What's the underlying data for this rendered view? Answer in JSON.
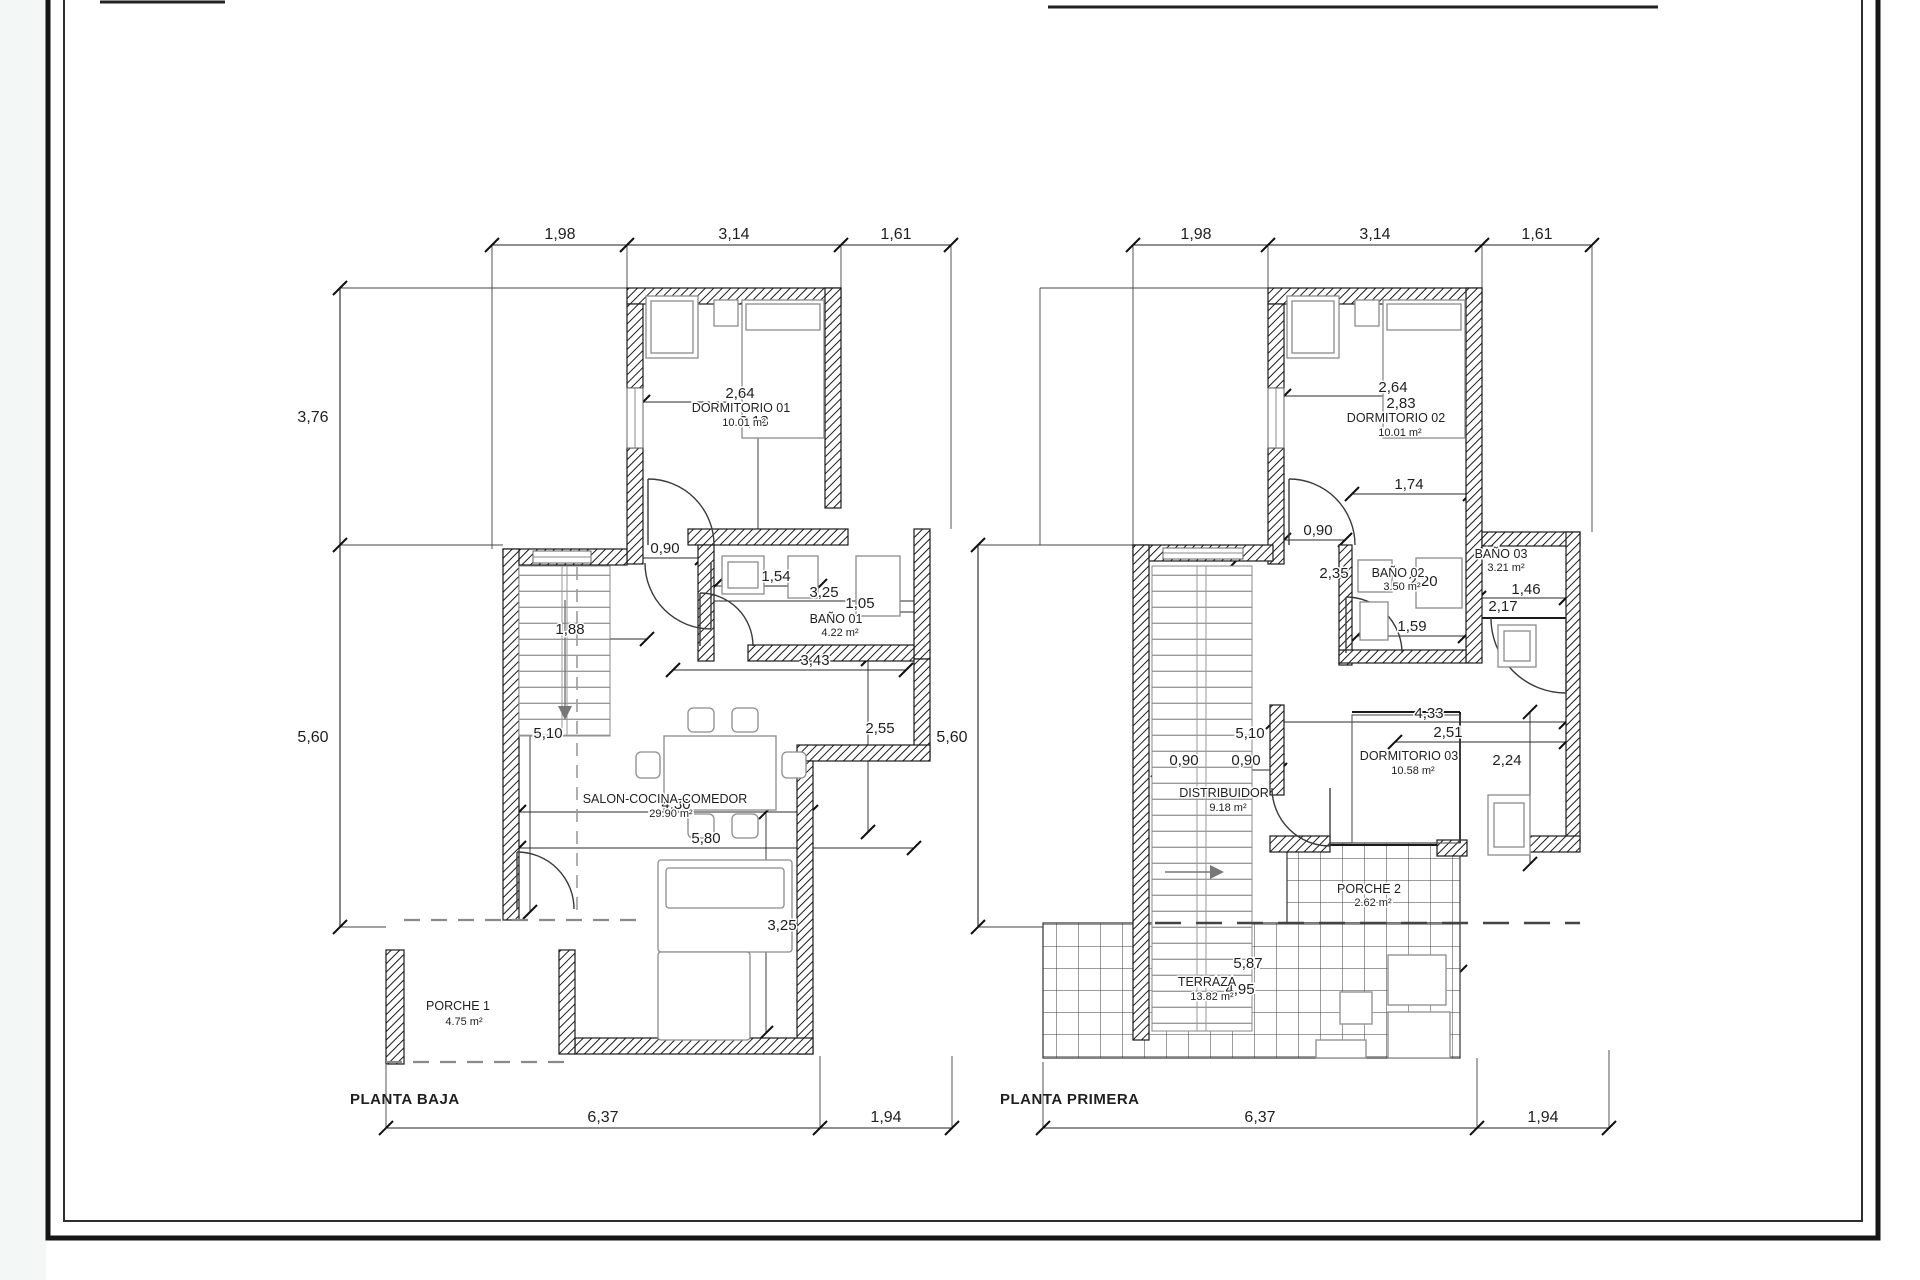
{
  "sheet": {
    "background": "#ffffff",
    "line_color": "#1a1a1a",
    "furniture_color": "#8c8c8c"
  },
  "plans": [
    {
      "title": "PLANTA BAJA",
      "rooms": [
        {
          "name": "DORMITORIO 01",
          "area": "10.01 m²"
        },
        {
          "name": "BAÑO 01",
          "area": "4.22 m²"
        },
        {
          "name": "SALON-COCINA-COMEDOR",
          "area": "29.90 m²"
        },
        {
          "name": "PORCHE 1",
          "area": "4.75 m²"
        }
      ],
      "dims_top": [
        "1,98",
        "3,14",
        "1,61"
      ],
      "dims_left": [
        "3,76",
        "5,60"
      ],
      "dims_bottom": [
        "6,37",
        "1,94"
      ],
      "dims_inner": [
        "2,64",
        "3,13",
        "0,90",
        "1,54",
        "3,25",
        "1,05",
        "1,88",
        "3,43",
        "5,10",
        "2,55",
        "4,30",
        "5,80",
        "3,25"
      ]
    },
    {
      "title": "PLANTA PRIMERA",
      "rooms": [
        {
          "name": "DORMITORIO 02",
          "area": "10.01 m²"
        },
        {
          "name": "BAÑO 02",
          "area": "3.50 m²"
        },
        {
          "name": "BAÑO 03",
          "area": "3.21 m²"
        },
        {
          "name": "DISTRIBUIDOR",
          "area": "9.18 m²"
        },
        {
          "name": "DORMITORIO 03",
          "area": "10.58 m²"
        },
        {
          "name": "PORCHE 2",
          "area": "2.62 m²"
        },
        {
          "name": "TERRAZA",
          "area": "13.82 m²"
        }
      ],
      "dims_top": [
        "1,98",
        "3,14",
        "1,61"
      ],
      "dims_left": [
        "5,60"
      ],
      "dims_bottom": [
        "6,37",
        "1,94"
      ],
      "dims_inner": [
        "2,64",
        "2,83",
        "1,74",
        "0,90",
        "2,35",
        "2,20",
        "1,59",
        "1,46",
        "2,17",
        "4,33",
        "2,51",
        "2,24",
        "5,10",
        "0,90",
        "0,90",
        "5,87",
        "4,95"
      ]
    }
  ]
}
